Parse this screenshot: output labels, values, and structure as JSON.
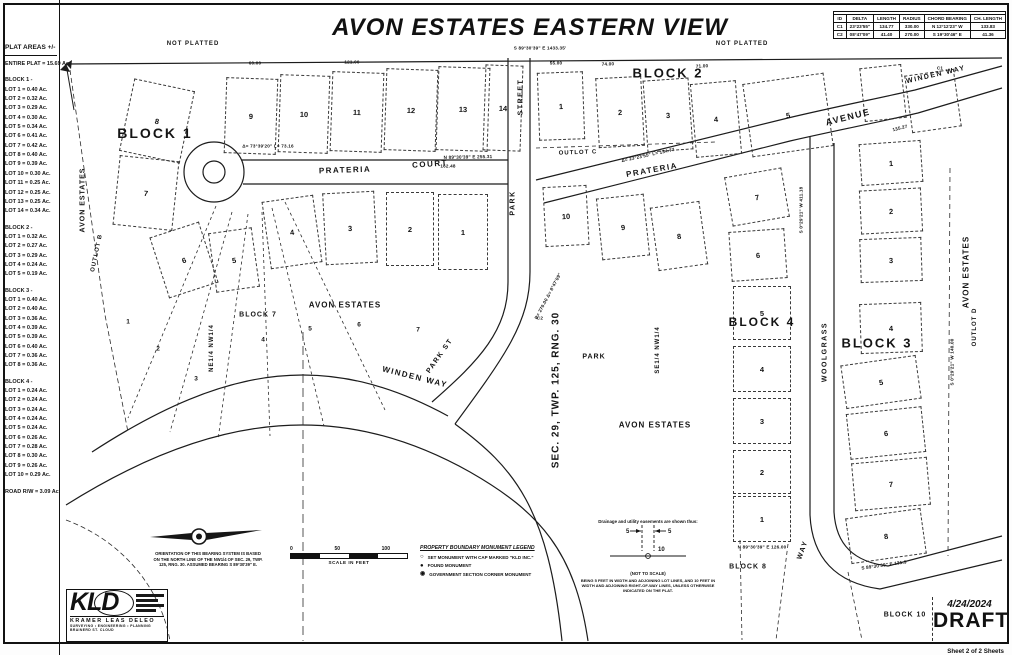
{
  "title": "AVON ESTATES EASTERN VIEW",
  "curve_table": {
    "title": "CURVE DATA TABLE",
    "headers": [
      "ID",
      "DELTA",
      "LENGTH",
      "RADIUS",
      "CHORD BEARING",
      "CH. LENGTH"
    ],
    "rows": [
      [
        "C1",
        "23°23'55\"",
        "134.77",
        "330.00",
        "N 12°12'23\" W",
        "133.83"
      ],
      [
        "C2",
        "08°47'09\"",
        "41.40",
        "270.00",
        "S 19°30'46\" E",
        "41.36"
      ]
    ]
  },
  "plat_areas": {
    "title": "PLAT AREAS +/-",
    "entire_plat": "ENTIRE PLAT = 15.69 Ac.",
    "sections": [
      {
        "heading": "BLOCK 1 -",
        "lots": [
          "LOT 1 = 0.40 Ac.",
          "LOT 2 = 0.32 Ac.",
          "LOT 3 = 0.29 Ac.",
          "LOT 4 = 0.30 Ac.",
          "LOT 5 = 0.34 Ac.",
          "LOT 6 = 0.41 Ac.",
          "LOT 7 = 0.42 Ac.",
          "LOT 8 = 0.40 Ac.",
          "LOT 9 = 0.39 Ac.",
          "LOT 10 = 0.30 Ac.",
          "LOT 11 = 0.25 Ac.",
          "LOT 12 = 0.25 Ac.",
          "LOT 13 = 0.25 Ac.",
          "LOT 14 = 0.34 Ac."
        ]
      },
      {
        "heading": "BLOCK 2 -",
        "lots": [
          "LOT 1 = 0.32 Ac.",
          "LOT 2 = 0.27 Ac.",
          "LOT 3 = 0.29 Ac.",
          "LOT 4 = 0.24 Ac.",
          "LOT 5 = 0.19 Ac."
        ]
      },
      {
        "heading": "BLOCK 3 -",
        "lots": [
          "LOT 1 = 0.40 Ac.",
          "LOT 2 = 0.40 Ac.",
          "LOT 3 = 0.36 Ac.",
          "LOT 4 = 0.39 Ac.",
          "LOT 5 = 0.39 Ac.",
          "LOT 6 = 0.40 Ac.",
          "LOT 7 = 0.36 Ac.",
          "LOT 8 = 0.36 Ac."
        ]
      },
      {
        "heading": "BLOCK 4 -",
        "lots": [
          "LOT 1 = 0.24 Ac.",
          "LOT 2 = 0.24 Ac.",
          "LOT 3 = 0.24 Ac.",
          "LOT 4 = 0.24 Ac.",
          "LOT 5 = 0.24 Ac.",
          "LOT 6 = 0.26 Ac.",
          "LOT 7 = 0.28 Ac.",
          "LOT 8 = 0.30 Ac.",
          "LOT 9 = 0.26 Ac.",
          "LOT 10 = 0.29 Ac."
        ]
      }
    ],
    "road": "ROAD R/W = 3.09 Ac."
  },
  "map": {
    "parcels": [
      [
        "9",
        225,
        78,
        52,
        76,
        2
      ],
      [
        "10",
        279,
        75,
        50,
        78,
        2
      ],
      [
        "11",
        331,
        72,
        52,
        80,
        2
      ],
      [
        "12",
        385,
        69,
        52,
        82,
        2
      ],
      [
        "13",
        437,
        67,
        52,
        84,
        2
      ],
      [
        "14",
        484,
        65,
        38,
        86,
        2
      ],
      [
        "8",
        126,
        84,
        62,
        74,
        12
      ],
      [
        "7",
        116,
        158,
        60,
        70,
        6
      ],
      [
        "6",
        158,
        228,
        52,
        64,
        -18
      ],
      [
        "5",
        212,
        230,
        44,
        60,
        -8
      ],
      [
        "4",
        266,
        198,
        52,
        68,
        -8
      ],
      [
        "3",
        324,
        192,
        52,
        72,
        -3
      ],
      [
        "2",
        386,
        192,
        48,
        74,
        0
      ],
      [
        "1",
        438,
        194,
        50,
        76,
        0
      ],
      [
        "1",
        538,
        72,
        46,
        68,
        -2
      ],
      [
        "2",
        597,
        77,
        46,
        70,
        -3
      ],
      [
        "3",
        645,
        79,
        46,
        72,
        -4
      ],
      [
        "4",
        693,
        82,
        46,
        74,
        -5
      ],
      [
        "5",
        747,
        78,
        82,
        74,
        -8
      ],
      [
        "",
        862,
        66,
        42,
        54,
        -6
      ],
      [
        "",
        908,
        72,
        50,
        58,
        -8
      ],
      [
        "10",
        544,
        186,
        44,
        60,
        -3
      ],
      [
        "9",
        599,
        196,
        48,
        62,
        -6
      ],
      [
        "8",
        654,
        204,
        50,
        64,
        -8
      ],
      [
        "7",
        728,
        172,
        58,
        50,
        -10
      ],
      [
        "6",
        730,
        230,
        56,
        50,
        -4
      ],
      [
        "5",
        733,
        286,
        58,
        54,
        0
      ],
      [
        "4",
        733,
        346,
        58,
        46,
        0
      ],
      [
        "3",
        733,
        398,
        58,
        46,
        0
      ],
      [
        "2",
        733,
        450,
        58,
        44,
        0
      ],
      [
        "1",
        733,
        496,
        58,
        46,
        0
      ],
      [
        "1",
        860,
        142,
        62,
        42,
        -4
      ],
      [
        "2",
        860,
        189,
        62,
        44,
        -3
      ],
      [
        "3",
        860,
        238,
        62,
        44,
        -2
      ],
      [
        "4",
        860,
        303,
        62,
        50,
        -2
      ],
      [
        "5",
        843,
        360,
        76,
        44,
        -8
      ],
      [
        "6",
        848,
        410,
        76,
        46,
        -6
      ],
      [
        "7",
        853,
        460,
        76,
        48,
        -5
      ],
      [
        "8",
        848,
        513,
        76,
        46,
        -8
      ]
    ],
    "lot_numbers": [
      [
        "1",
        128,
        322
      ],
      [
        "2",
        158,
        349
      ],
      [
        "3",
        196,
        379
      ],
      [
        "4",
        263,
        340
      ],
      [
        "5",
        310,
        329
      ],
      [
        "6",
        359,
        325
      ],
      [
        "7",
        418,
        330
      ]
    ],
    "street_labels": [
      [
        "PRATERIA",
        345,
        170,
        -2,
        8
      ],
      [
        "COURT",
        430,
        164,
        -4,
        8
      ],
      [
        "STREET",
        521,
        97,
        -90,
        7
      ],
      [
        "PARK",
        513,
        203,
        -90,
        7
      ],
      [
        "PARK ST",
        440,
        356,
        -55,
        7
      ],
      [
        "PRATERIA",
        652,
        170,
        -10,
        8
      ],
      [
        "AVENUE",
        848,
        117,
        -14,
        9
      ],
      [
        "WINDEN WAY",
        936,
        75,
        -13,
        7
      ],
      [
        "WINDEN WAY",
        415,
        377,
        14,
        8
      ],
      [
        "WOOLGRASS",
        825,
        352,
        -90,
        7
      ],
      [
        "WAY",
        803,
        550,
        -70,
        7
      ]
    ],
    "area_labels": [
      [
        "BLOCK 1",
        155,
        133,
        0,
        14
      ],
      [
        "BLOCK 2",
        668,
        73,
        0,
        13
      ],
      [
        "BLOCK 3",
        877,
        343,
        0,
        13
      ],
      [
        "BLOCK 4",
        762,
        322,
        0,
        12
      ],
      [
        "BLOCK 7",
        258,
        315,
        0,
        7
      ],
      [
        "BLOCK 8",
        748,
        567,
        0,
        7
      ],
      [
        "BLOCK 10",
        905,
        615,
        0,
        7
      ],
      [
        "AVON ESTATES",
        83,
        200,
        -90,
        7
      ],
      [
        "AVON ESTATES",
        345,
        305,
        0,
        8
      ],
      [
        "AVON ESTATES",
        655,
        425,
        0,
        8
      ],
      [
        "AVON ESTATES",
        966,
        272,
        -90,
        8
      ],
      [
        "OUTLOT B",
        97,
        253,
        -78,
        6
      ],
      [
        "OUTLOT C",
        578,
        153,
        -2,
        6
      ],
      [
        "OUTLOT D",
        975,
        327,
        -90,
        6
      ],
      [
        "PARK",
        594,
        357,
        0,
        7
      ],
      [
        "NE1/4 NW1/4",
        212,
        348,
        -90,
        6
      ],
      [
        "SE1/4 NW1/4",
        658,
        350,
        -90,
        6
      ],
      [
        "SEC. 29, TWP. 125, RNG. 30",
        556,
        390,
        -90,
        10
      ],
      [
        "NOT PLATTED",
        193,
        44,
        0,
        6
      ],
      [
        "NOT PLATTED",
        742,
        44,
        0,
        6
      ]
    ],
    "dims": [
      [
        "S 89°30'39\" E  1433.35'",
        540,
        48,
        0
      ],
      [
        "N 89°30'39\" E  255.31",
        468,
        157,
        -1
      ],
      [
        "162.48",
        448,
        166,
        0
      ],
      [
        "121.00",
        352,
        62,
        0
      ],
      [
        "60.00",
        255,
        63,
        0
      ],
      [
        "55.00",
        556,
        63,
        0
      ],
      [
        "74.00",
        608,
        64,
        -2
      ],
      [
        "71.00",
        702,
        66,
        -3
      ],
      [
        "Δ= 73°39'20\"  L= 73.16",
        268,
        146,
        0
      ],
      [
        "Δ= 23°23'55\"  L= 134.77",
        648,
        155,
        -12
      ],
      [
        "R= 270.00  Δ= 8°47'09\"",
        548,
        296,
        -62
      ],
      [
        "C1",
        940,
        68,
        0
      ],
      [
        "C2",
        540,
        318,
        0
      ],
      [
        "S 0°29'21\" W  411.18",
        801,
        210,
        -90
      ],
      [
        "135.27",
        900,
        128,
        -15
      ],
      [
        "N 89°30'39\" E  126.00",
        762,
        547,
        0
      ],
      [
        "S 89°30'39\" E  131.9",
        884,
        565,
        -8
      ],
      [
        "S 0°29'21\" W  140.00",
        952,
        362,
        -90
      ]
    ]
  },
  "north_note": "ORIENTATION OF THIS BEARING SYSTEM IS BASED ON THE NORTH LINE OF THE NW1/4 OF SEC. 29, TWP. 125, RNG. 30. ASSUMED BEARING S 89°30'39\" E.",
  "scale_bar": {
    "ticks": [
      "0",
      "50",
      "100"
    ],
    "label": "SCALE IN FEET"
  },
  "legend": {
    "title": "PROPERTY BOUNDARY MONUMENT LEGEND",
    "items": [
      {
        "symbol": "○",
        "label": "SET MONUMENT WITH CAP MARKED \"KLD INC.\""
      },
      {
        "symbol": "●",
        "label": "FOUND MONUMENT"
      },
      {
        "symbol": "◉",
        "label": "GOVERNMENT SECTION CORNER MONUMENT"
      }
    ]
  },
  "easement": {
    "title": "Drainage and utility easements are shown thus:",
    "width_lot": "5",
    "width_row": "10",
    "caption": "(NOT TO SCALE)",
    "note": "BEING 5 FEET IN WIDTH AND ADJOINING LOT LINES, AND 10 FEET IN WIDTH AND ADJOINING RIGHT-OF-WAY LINES, UNLESS OTHERWISE INDICATED ON THE PLAT."
  },
  "firm": {
    "initials": "KLD",
    "name": "KRAMER LEAS DELEO",
    "services": "SURVEYING • ENGINEERING • PLANNING",
    "offices": "BRAINERD    ST. CLOUD"
  },
  "sheet": {
    "date": "4/24/2024",
    "status": "DRAFT",
    "label": "Sheet 2 of 2 Sheets"
  }
}
